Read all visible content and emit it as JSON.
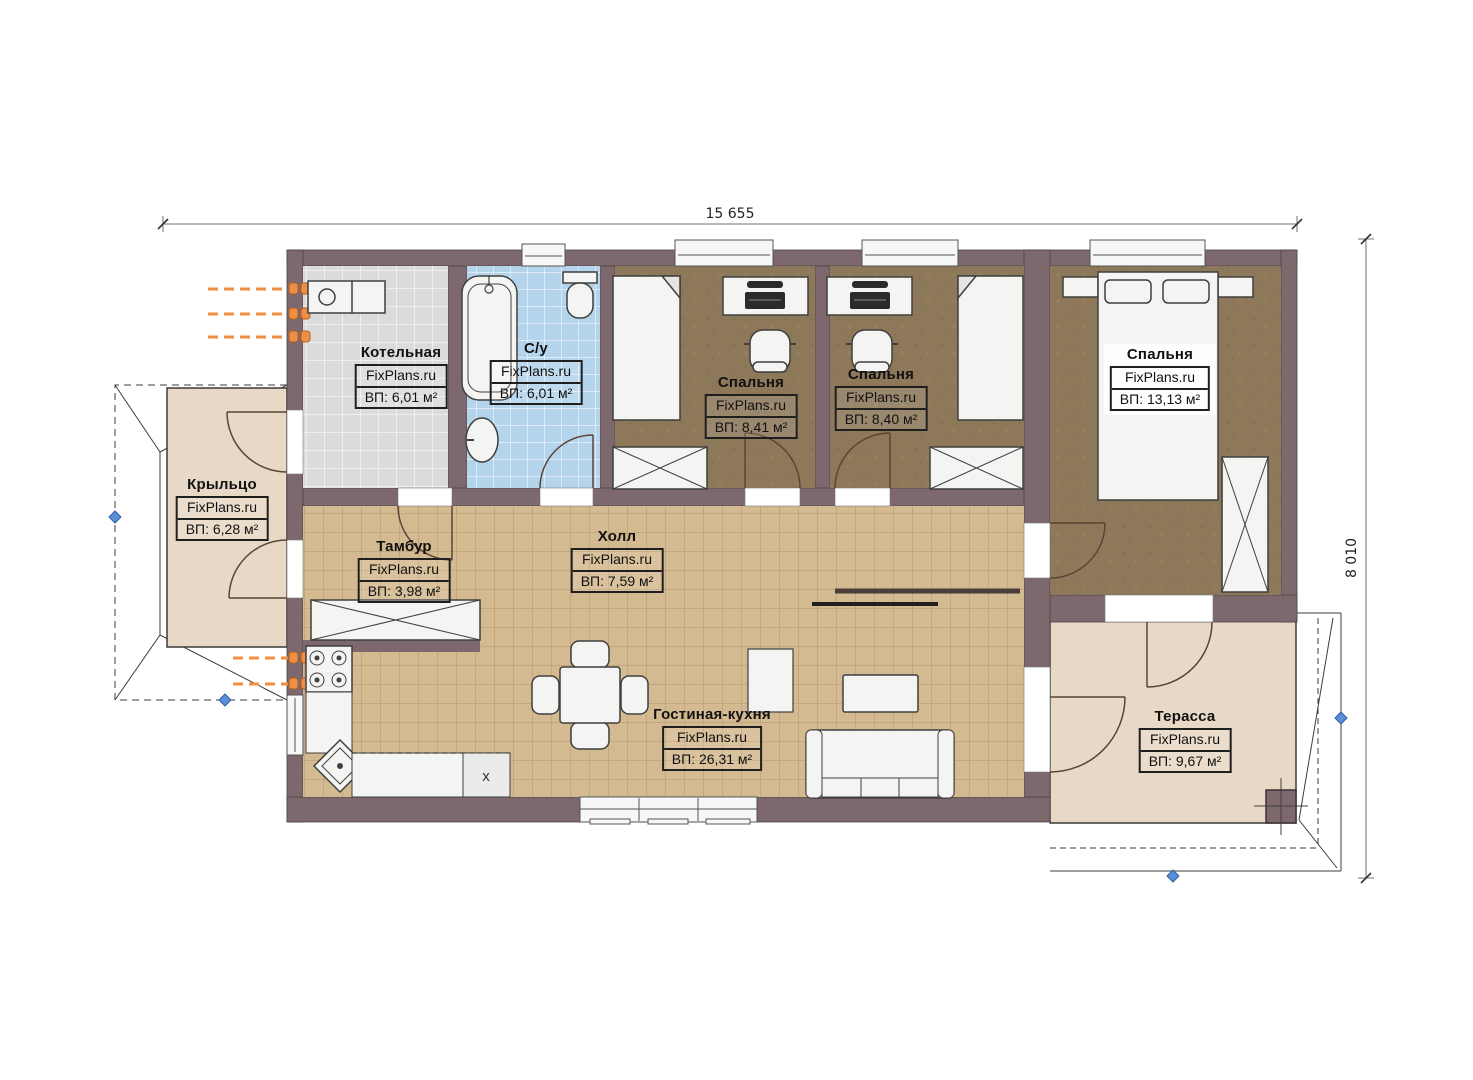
{
  "watermark": "FixPlans.ru",
  "dimensions": {
    "width": "15 655",
    "height": "8 010"
  },
  "rooms": {
    "kotelnaya": {
      "name": "Котельная",
      "area": "ВП: 6,01 м²"
    },
    "su": {
      "name": "С/у",
      "area": "ВП: 6,01 м²"
    },
    "bedroom1": {
      "name": "Спальня",
      "area": "ВП: 8,41 м²"
    },
    "bedroom2": {
      "name": "Спальня",
      "area": "ВП: 8,40 м²"
    },
    "bedroom3": {
      "name": "Спальня",
      "area": "ВП: 13,13 м²"
    },
    "porch": {
      "name": "Крыльцо",
      "area": "ВП: 6,28 м²"
    },
    "tambur": {
      "name": "Тамбур",
      "area": "ВП: 3,98 м²"
    },
    "hall": {
      "name": "Холл",
      "area": "ВП: 7,59 м²"
    },
    "living": {
      "name": "Гостиная-кухня",
      "area": "ВП: 26,31 м²"
    },
    "terrace": {
      "name": "Терасса",
      "area": "ВП: 9,67 м²"
    }
  },
  "marks": {
    "kitchen_unit": "x"
  },
  "colors": {
    "wall": "#7d696d",
    "floor_tile_gray": "#dbdbdb",
    "floor_tile_blue": "#b4d4ec",
    "floor_tan": "#d4ba90",
    "floor_bedroom": "#8d785a",
    "floor_beige": "#e7d9c5",
    "radiator_orange": "#ef8f45",
    "node_blue": "#5b8ed6"
  }
}
